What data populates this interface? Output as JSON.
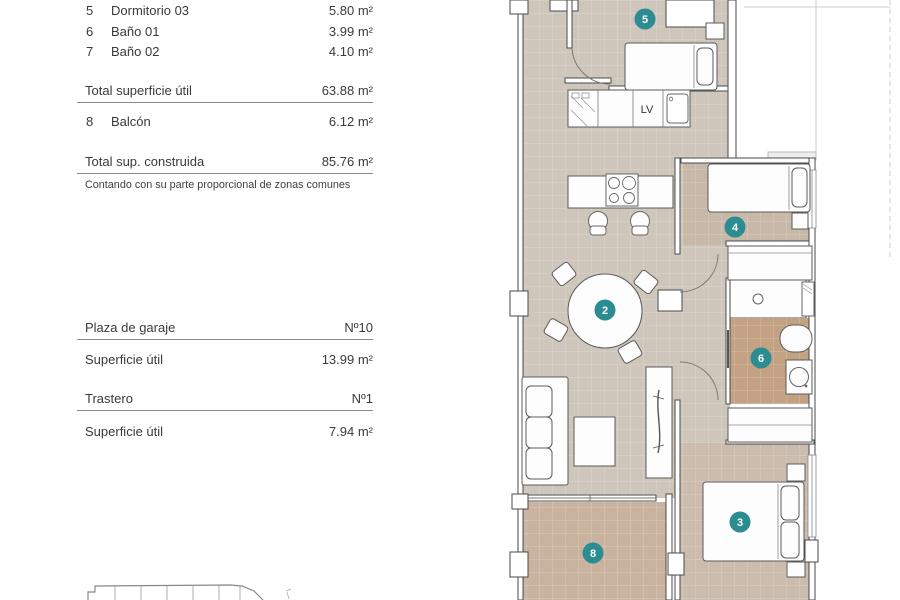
{
  "panel": {
    "rooms": [
      {
        "num": "5",
        "label": "Dormitorio 03",
        "value": "5.80 m²"
      },
      {
        "num": "6",
        "label": "Baño 01",
        "value": "3.99 m²"
      },
      {
        "num": "7",
        "label": "Baño 02",
        "value": "4.10 m²"
      }
    ],
    "total_useful": {
      "label": "Total superficie útil",
      "value": "63.88 m²"
    },
    "balcony": {
      "num": "8",
      "label": "Balcón",
      "value": "6.12 m²"
    },
    "total_built": {
      "label": "Total sup. construida",
      "value": "85.76 m²"
    },
    "footnote": "Contando con su parte proporcional de zonas comunes",
    "garage": {
      "label": "Plaza de garaje",
      "value": "Nº10"
    },
    "garage_area": {
      "label": "Superficie útil",
      "value": "13.99 m²"
    },
    "storage": {
      "label": "Trastero",
      "value": "Nº1"
    },
    "storage_area": {
      "label": "Superficie útil",
      "value": "7.94 m²"
    }
  },
  "plan": {
    "appliance_label": "LV",
    "badges": [
      {
        "number": "5"
      },
      {
        "number": "4"
      },
      {
        "number": "2"
      },
      {
        "number": "6"
      },
      {
        "number": "3"
      },
      {
        "number": "8"
      }
    ],
    "colors": {
      "floor_main": "#cfc6bb",
      "floor_bedroom": "#c7b8a8",
      "floor_bedroom3": "#cbbcad",
      "floor_bath": "#c2a283",
      "floor_balcony": "#c9b39e",
      "badge": "#2b8c92"
    }
  }
}
